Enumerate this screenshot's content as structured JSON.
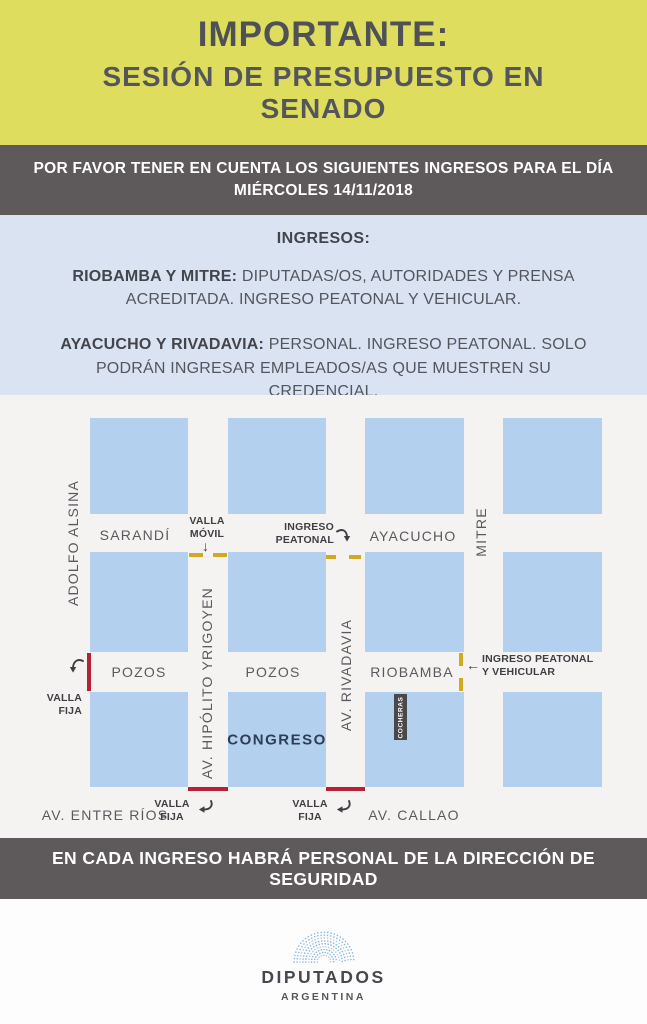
{
  "header": {
    "title": "IMPORTANTE:",
    "subtitle_line1": "SESIÓN DE PRESUPUESTO EN",
    "subtitle_line2": "SENADO"
  },
  "notice": {
    "line1": "POR FAVOR TENER EN CUENTA LOS SIGUIENTES INGRESOS PARA EL DÍA",
    "line2": "MIÉRCOLES 14/11/2018"
  },
  "info": {
    "heading": "INGRESOS:",
    "entries": [
      {
        "lead": "RIOBAMBA Y MITRE:",
        "text": " DIPUTADAS/OS, AUTORIDADES Y PRENSA ACREDITADA. INGRESO PEATONAL Y VEHICULAR."
      },
      {
        "lead": "AYACUCHO Y RIVADAVIA:",
        "text": " PERSONAL. INGRESO PEATONAL. SOLO PODRÁN INGRESAR EMPLEADOS/AS QUE MUESTREN SU CREDENCIAL."
      }
    ]
  },
  "map": {
    "streets": {
      "adolfo_alsina": "ADOLFO ALSINA",
      "sarandi": "SARANDÍ",
      "ayacucho": "AYACUCHO",
      "mitre": "MITRE",
      "pozos_1": "POZOS",
      "pozos_2": "POZOS",
      "riobamba": "RIOBAMBA",
      "hipolito_yrigoyen": "AV. HIPÓLITO YRIGOYEN",
      "rivadavia": "AV. RIVADAVIA",
      "entre_rios": "AV. ENTRE RÍOS",
      "callao": "AV. CALLAO"
    },
    "labels": {
      "congreso": "CONGRESO",
      "cocheras": "COCHERAS",
      "valla_movil": "VALLA MÓVIL",
      "ingreso_peatonal": "INGRESO PEATONAL",
      "valla_fija_left": "VALLA FIJA",
      "valla_fija_bottom_1": "VALLA FIJA",
      "valla_fija_bottom_2": "VALLA FIJA",
      "ingreso_peatonal_vehicular": "INGRESO PEATONAL Y VEHICULAR"
    },
    "icons": {
      "down_arrow": "↓",
      "left_arrow": "←"
    },
    "colors": {
      "barrier_fixed_red": "#b82037",
      "barrier_mobile_yellow": "#d2a922",
      "city_block_blue": "#b3d1ef"
    }
  },
  "security": {
    "text": "EN CADA INGRESO HABRÁ PERSONAL DE LA DIRECCIÓN DE SEGURIDAD"
  },
  "footer": {
    "org": "DIPUTADOS",
    "country": "ARGENTINA"
  }
}
